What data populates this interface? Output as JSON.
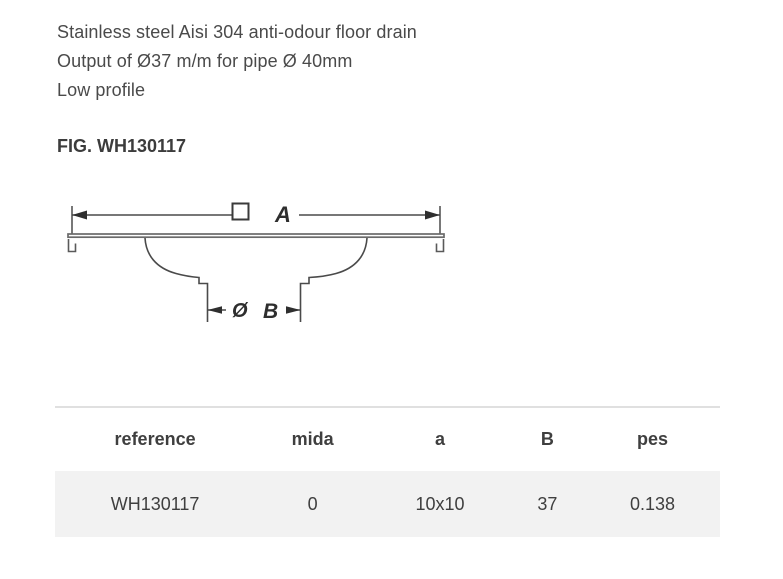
{
  "intro": {
    "lines": [
      "Stainless steel Aisi 304 anti-odour floor drain",
      "Output of Ø37 m/m for pipe Ø 40mm",
      "Low profile"
    ]
  },
  "figure": {
    "title": "FIG. WH130117",
    "diagram_labels": {
      "overall_width": "A",
      "outlet_diameter_symbol": "Ø",
      "outlet_width": "B"
    }
  },
  "table": {
    "headers": [
      "reference",
      "mida",
      "a",
      "B",
      "pes"
    ],
    "rows": [
      [
        "WH130117",
        "0",
        "10x10",
        "37",
        "0.138"
      ]
    ]
  },
  "colors": {
    "body_text": "#4a4a4a",
    "heading_text": "#3c3c3c",
    "row_background": "#f2f2f2",
    "table_top_border": "#e0e0e0",
    "drawing_line": "#4a4a4a",
    "plate_line": "#6a6a6a"
  }
}
